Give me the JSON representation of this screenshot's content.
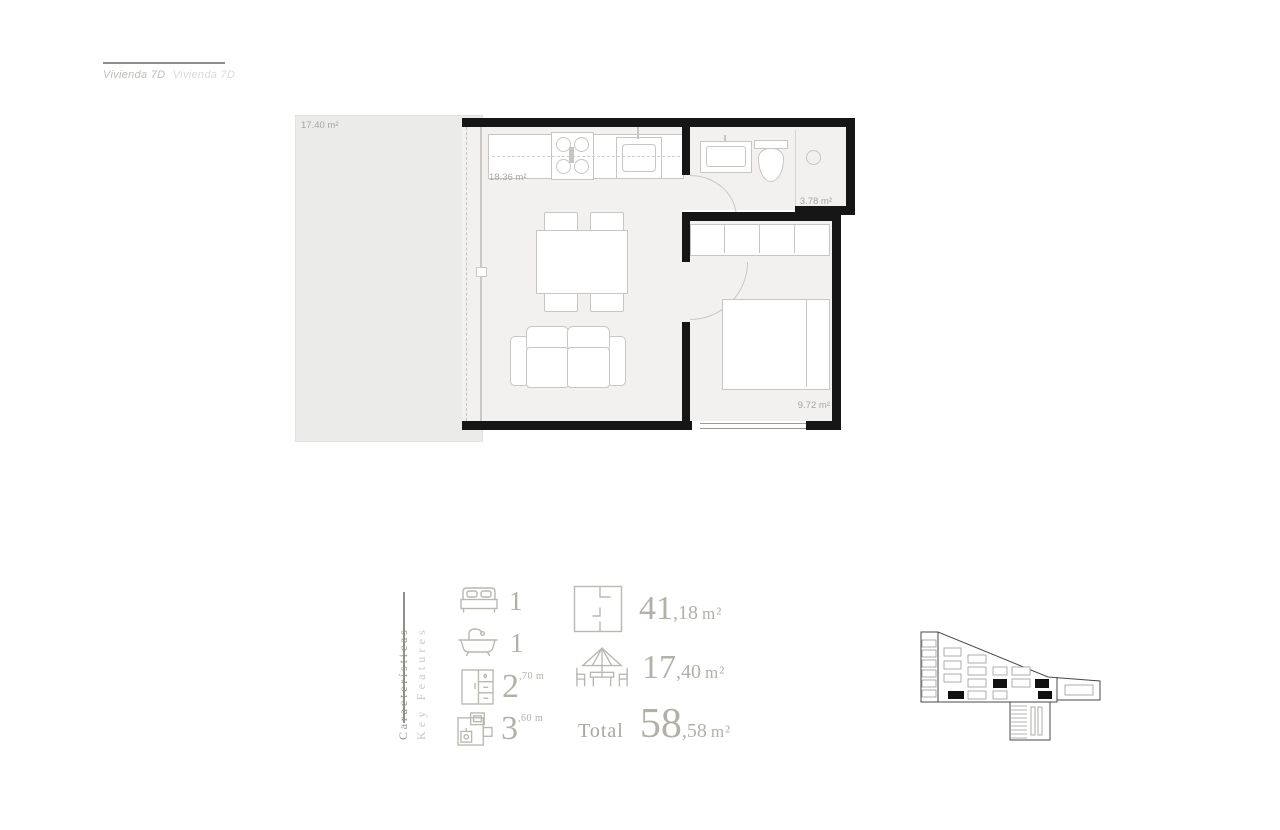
{
  "header": {
    "title_primary": "Vivienda 7D",
    "title_secondary": "Vivienda 7D"
  },
  "floor_plan": {
    "terrace_label": "17.40 m²",
    "living_label": "18.36 m²",
    "bath_label": "3.78 m²",
    "bedroom_label": "9.72 m²"
  },
  "features": {
    "heading_es": "Características",
    "heading_en": "Key Features",
    "items": [
      {
        "name": "bedrooms",
        "icon": "bed-icon",
        "value": "1",
        "detail": ""
      },
      {
        "name": "bathrooms",
        "icon": "bathtub-icon",
        "value": "1",
        "detail": ""
      },
      {
        "name": "wardrobe",
        "icon": "wardrobe-icon",
        "value": "2",
        "detail": ",70 m"
      },
      {
        "name": "kitchen",
        "icon": "kitchen-icon",
        "value": "3",
        "detail": ",60 m"
      }
    ]
  },
  "areas": {
    "built": {
      "whole": "41",
      "fraction": ",18",
      "unit": "m²"
    },
    "terrace": {
      "whole": "17",
      "fraction": ",40",
      "unit": "m²"
    },
    "total": {
      "label": "Total",
      "whole": "58",
      "fraction": ",58",
      "unit": "m²"
    }
  },
  "colors": {
    "wall": "#161616",
    "interior_fill": "#f2f1ef",
    "terrace_fill": "#ebebe9",
    "furniture_stroke": "#c7c6c2",
    "plan_label": "#a7a6a1",
    "legend_primary": "#94938c",
    "legend_secondary": "#c9c8c1",
    "figure_text": "#b2b0a9"
  }
}
